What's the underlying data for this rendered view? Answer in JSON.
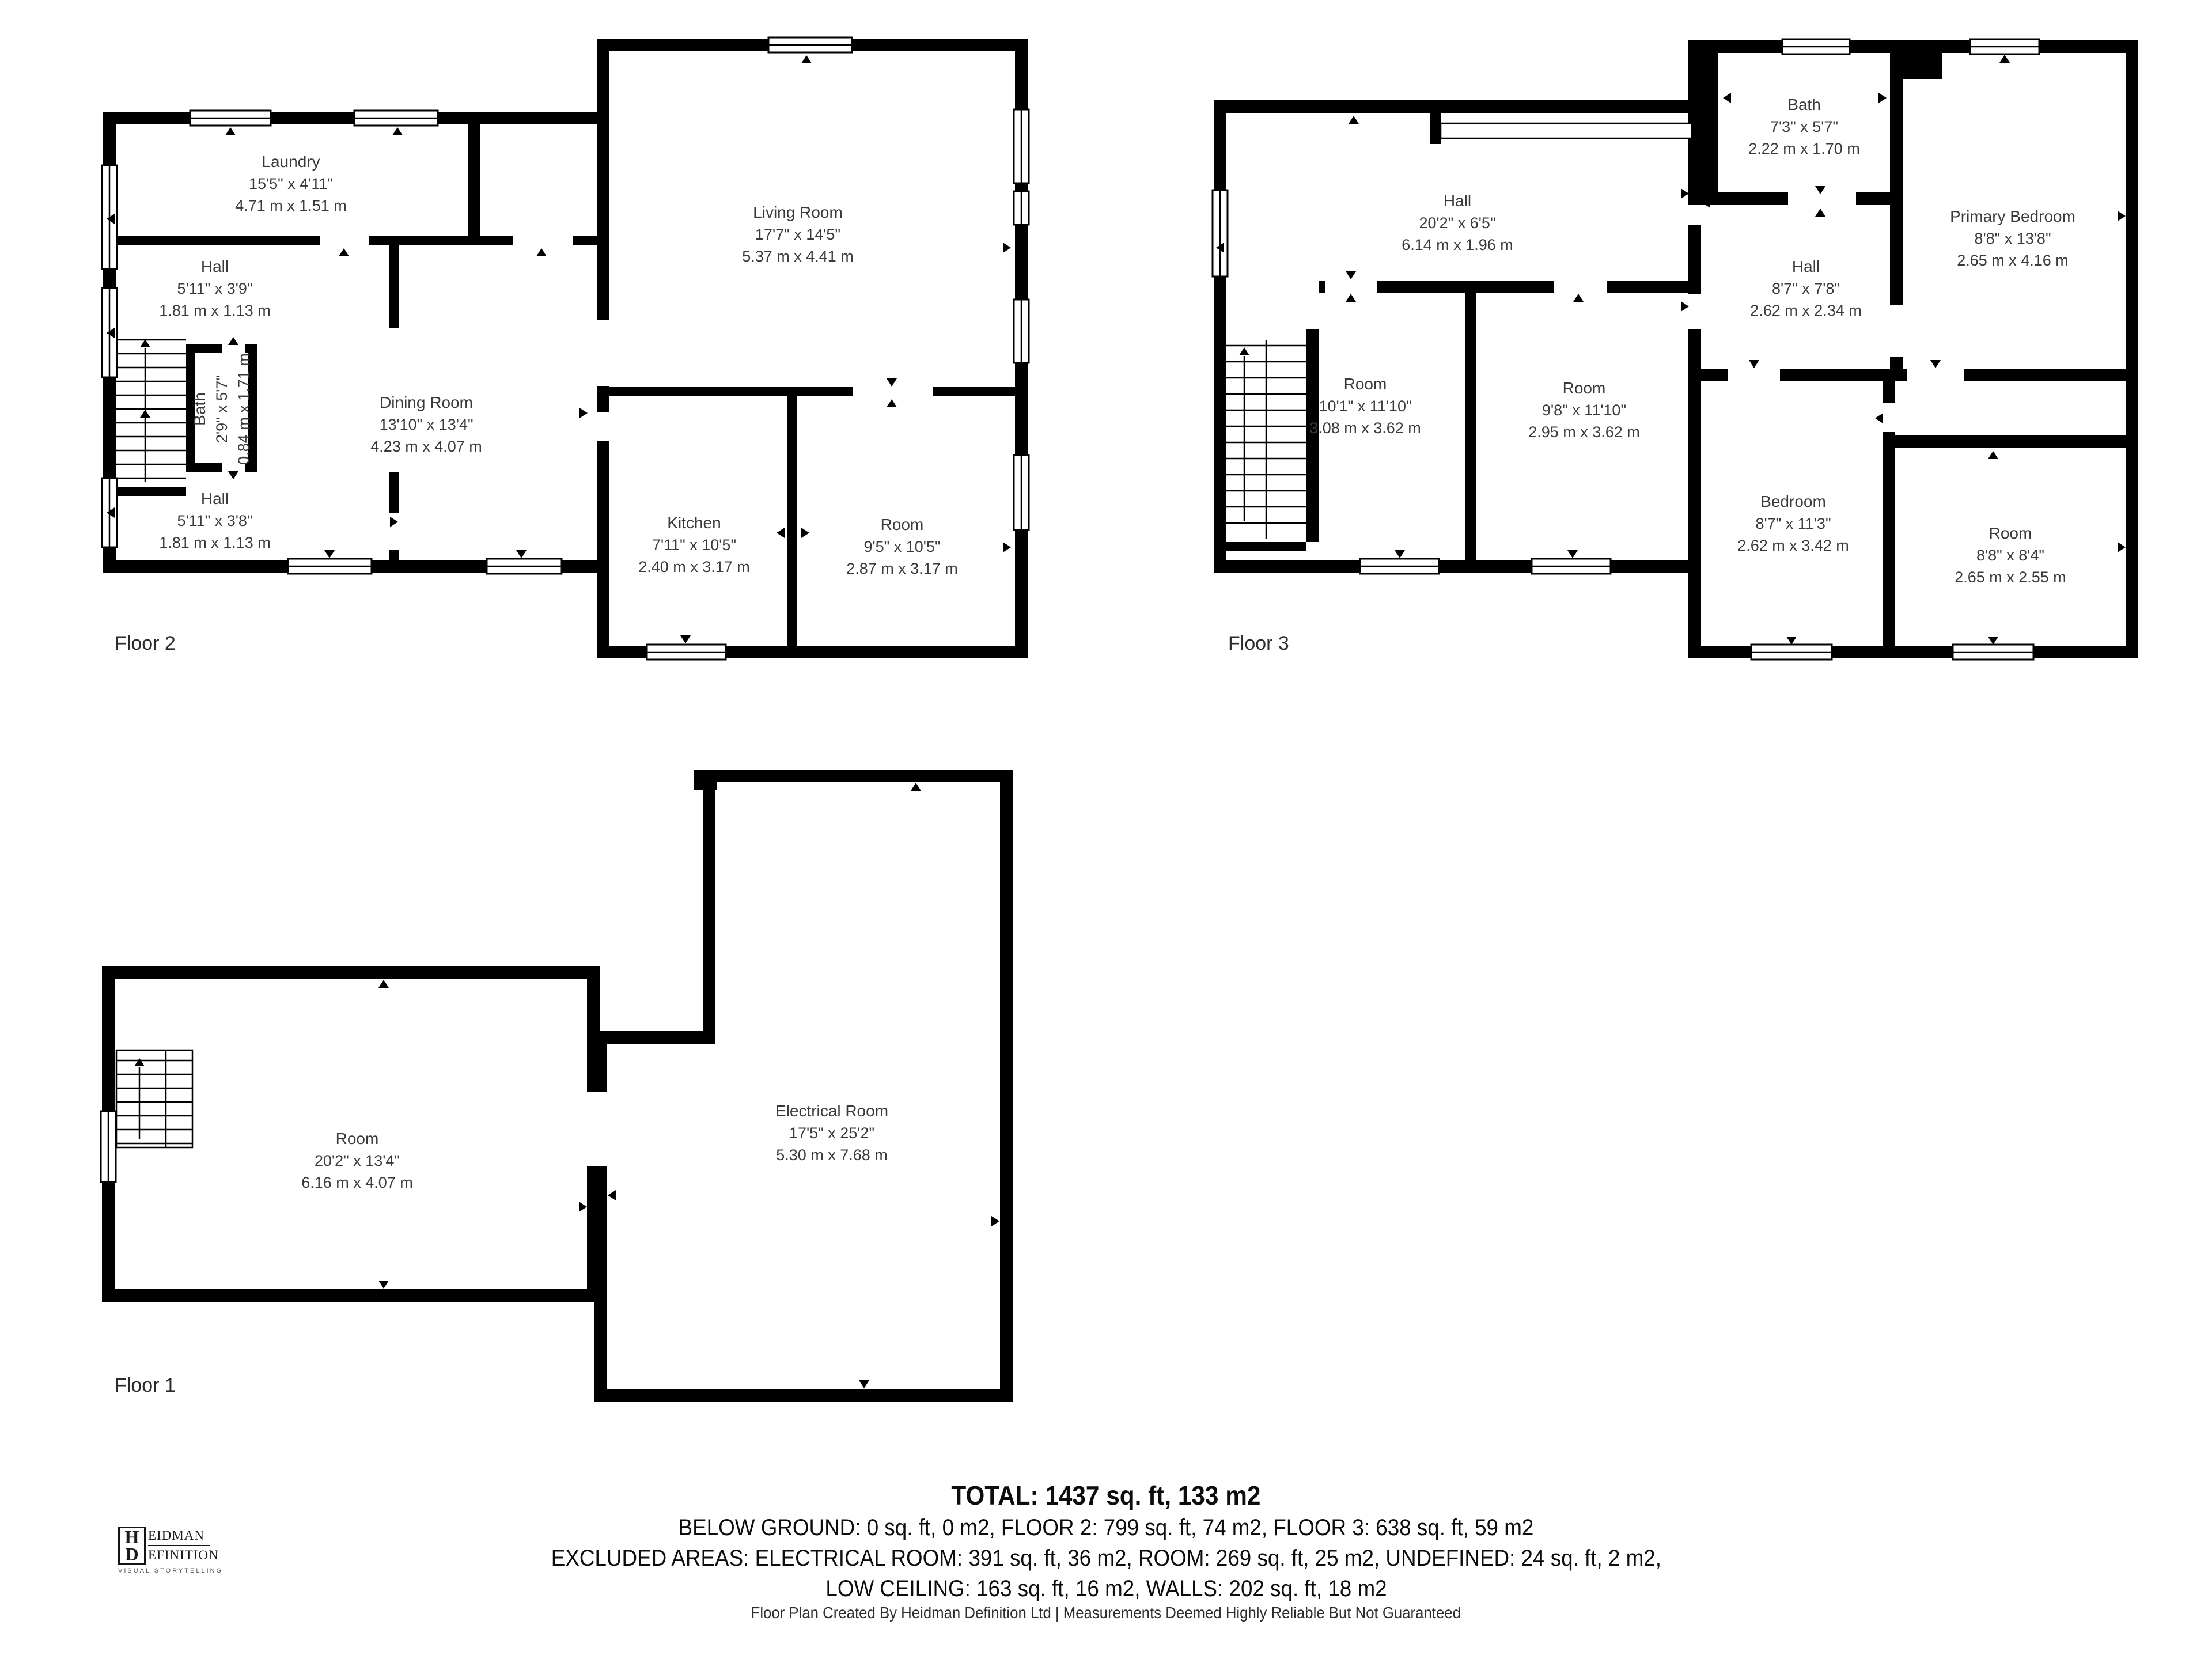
{
  "floors": [
    {
      "label": "Floor 2",
      "rooms": {
        "laundry": {
          "name": "Laundry",
          "imperial": "15'5\" x 4'11\"",
          "metric": "4.71 m x 1.51 m"
        },
        "hall_top": {
          "name": "Hall",
          "imperial": "5'11\" x 3'9\"",
          "metric": "1.81 m x 1.13 m"
        },
        "bath": {
          "name": "Bath",
          "imperial": "2'9\" x 5'7\"",
          "metric": "0.84 m x 1.71 m"
        },
        "hall_bottom": {
          "name": "Hall",
          "imperial": "5'11\" x 3'8\"",
          "metric": "1.81 m x 1.13 m"
        },
        "dining": {
          "name": "Dining Room",
          "imperial": "13'10\" x 13'4\"",
          "metric": "4.23 m x 4.07 m"
        },
        "living": {
          "name": "Living Room",
          "imperial": "17'7\" x 14'5\"",
          "metric": "5.37 m x 4.41 m"
        },
        "kitchen": {
          "name": "Kitchen",
          "imperial": "7'11\" x 10'5\"",
          "metric": "2.40 m x 3.17 m"
        },
        "room": {
          "name": "Room",
          "imperial": "9'5\" x 10'5\"",
          "metric": "2.87 m x 3.17 m"
        }
      }
    },
    {
      "label": "Floor 3",
      "rooms": {
        "hall_top": {
          "name": "Hall",
          "imperial": "20'2\" x 6'5\"",
          "metric": "6.14 m x 1.96 m"
        },
        "bath": {
          "name": "Bath",
          "imperial": "7'3\" x 5'7\"",
          "metric": "2.22 m x 1.70 m"
        },
        "primary": {
          "name": "Primary Bedroom",
          "imperial": "8'8\" x 13'8\"",
          "metric": "2.65 m x 4.16 m"
        },
        "hall_mid": {
          "name": "Hall",
          "imperial": "8'7\" x 7'8\"",
          "metric": "2.62 m x 2.34 m"
        },
        "room_left": {
          "name": "Room",
          "imperial": "10'1\" x 11'10\"",
          "metric": "3.08 m x 3.62 m"
        },
        "room_mid": {
          "name": "Room",
          "imperial": "9'8\" x 11'10\"",
          "metric": "2.95 m x 3.62 m"
        },
        "bedroom": {
          "name": "Bedroom",
          "imperial": "8'7\" x 11'3\"",
          "metric": "2.62 m x 3.42 m"
        },
        "room_br": {
          "name": "Room",
          "imperial": "8'8\" x 8'4\"",
          "metric": "2.65 m x 2.55 m"
        }
      }
    },
    {
      "label": "Floor 1",
      "rooms": {
        "room": {
          "name": "Room",
          "imperial": "20'2\" x 13'4\"",
          "metric": "6.16 m x 4.07 m"
        },
        "electrical": {
          "name": "Electrical Room",
          "imperial": "17'5\" x 25'2\"",
          "metric": "5.30 m x 7.68 m"
        }
      }
    }
  ],
  "summary": {
    "total": "TOTAL: 1437 sq. ft, 133 m2",
    "line2": "BELOW GROUND: 0 sq. ft, 0 m2, FLOOR 2: 799 sq. ft, 74 m2, FLOOR 3: 638 sq. ft, 59 m2",
    "line3": "EXCLUDED AREAS: ELECTRICAL ROOM: 391 sq. ft, 36 m2, ROOM: 269 sq. ft, 25 m2, UNDEFINED: 24 sq. ft, 2 m2,",
    "line4": "LOW CEILING: 163 sq. ft, 16 m2, WALLS: 202 sq. ft, 18 m2"
  },
  "footer": "Floor Plan Created By Heidman Definition Ltd | Measurements Deemed Highly Reliable But Not Guaranteed",
  "logo": {
    "initial_top": "H",
    "initial_bottom": "D",
    "word_top": "EIDMAN",
    "word_bottom": "EFINITION",
    "tagline": "VISUAL STORYTELLING"
  },
  "colors": {
    "wall": "#000000",
    "room_text": "#3a3a3a",
    "summary_text": "#0c0c0c"
  }
}
